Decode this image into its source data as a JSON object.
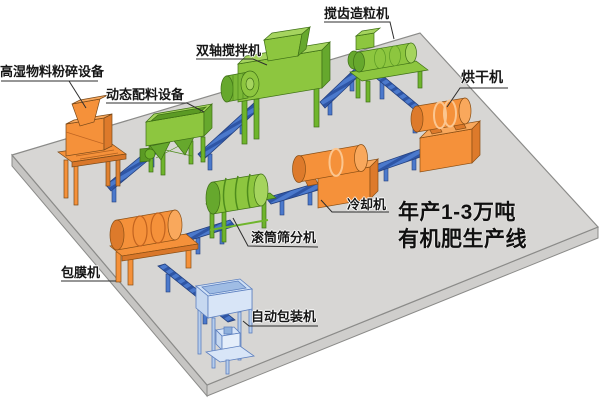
{
  "scene": {
    "background": "#ffffff",
    "platform_top_color": "#d7d6d4",
    "platform_side_color": "#c6c5c3",
    "outline_color": "#8b8b89",
    "conveyor_color": "#4b79cc",
    "conveyor_stripe_color": "#2e55a5",
    "label_color": "#161616"
  },
  "title": {
    "line1": "年产1-3万吨",
    "line2": "有机肥生产线"
  },
  "machines": [
    {
      "id": "crusher",
      "label": "高湿物料粉碎设备",
      "color": "#f5913a"
    },
    {
      "id": "batching",
      "label": "动态配料设备",
      "color": "#8dc63f"
    },
    {
      "id": "mixer",
      "label": "双轴搅拌机",
      "color": "#8dc63f"
    },
    {
      "id": "granulator",
      "label": "搅齿造粒机",
      "color": "#8dc63f"
    },
    {
      "id": "dryer",
      "label": "烘干机",
      "color": "#f5913a"
    },
    {
      "id": "cooler",
      "label": "冷却机",
      "color": "#f5913a"
    },
    {
      "id": "screener",
      "label": "滚筒筛分机",
      "color": "#8dc63f"
    },
    {
      "id": "coater",
      "label": "包膜机",
      "color": "#f5913a"
    },
    {
      "id": "packer",
      "label": "自动包装机",
      "color": "#cfe0f5"
    }
  ]
}
